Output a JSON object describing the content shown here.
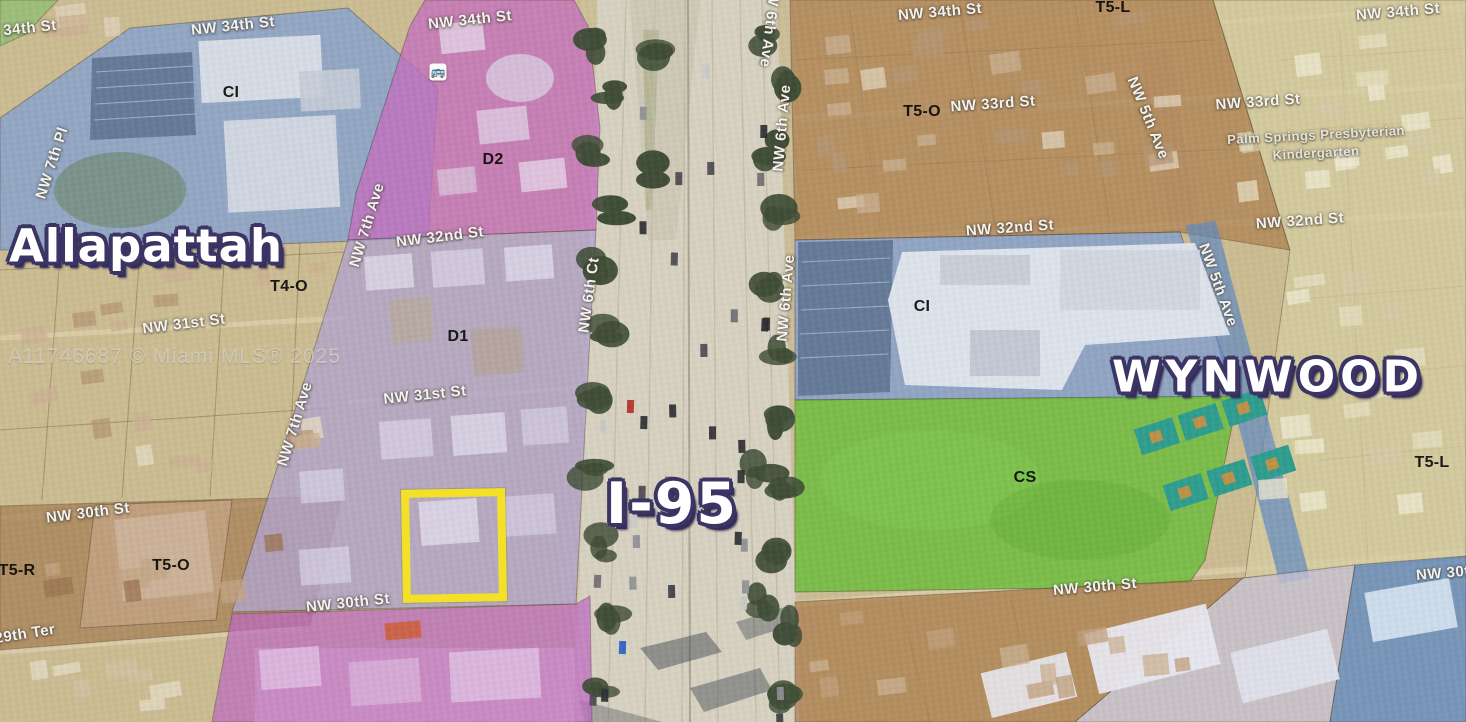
{
  "map": {
    "watermark": {
      "text": "A11746687 © Miami MLS® 2025"
    },
    "neighborhood_labels": [
      {
        "text": "Allapattah",
        "x": 146,
        "y": 246,
        "size": 45,
        "rot": 0,
        "spacing": 1
      },
      {
        "text": "WYNWOOD",
        "x": 1268,
        "y": 377,
        "size": 44,
        "rot": 0,
        "spacing": 5
      },
      {
        "text": "I-95",
        "x": 672,
        "y": 504,
        "size": 57,
        "rot": 0,
        "spacing": 2
      }
    ],
    "zone_labels": [
      {
        "text": "CI",
        "x": 231,
        "y": 93
      },
      {
        "text": "D2",
        "x": 493,
        "y": 160
      },
      {
        "text": "T4-O",
        "x": 289,
        "y": 287
      },
      {
        "text": "D1",
        "x": 458,
        "y": 337
      },
      {
        "text": "T5-O",
        "x": 171,
        "y": 566
      },
      {
        "text": "T5-R",
        "x": 17,
        "y": 571
      },
      {
        "text": "T5-L",
        "x": 1113,
        "y": 8
      },
      {
        "text": "T5-O",
        "x": 922,
        "y": 112
      },
      {
        "text": "CI",
        "x": 922,
        "y": 307
      },
      {
        "text": "CS",
        "x": 1025,
        "y": 478
      },
      {
        "text": "T5-L",
        "x": 1432,
        "y": 463
      }
    ],
    "street_labels": [
      {
        "text": "34th St",
        "x": 30,
        "y": 28,
        "rot": -6
      },
      {
        "text": "NW 34th St",
        "x": 233,
        "y": 26,
        "rot": -6
      },
      {
        "text": "NW 34th St",
        "x": 470,
        "y": 20,
        "rot": -6
      },
      {
        "text": "NW 34th St",
        "x": 940,
        "y": 12,
        "rot": -5
      },
      {
        "text": "NW 34th St",
        "x": 1398,
        "y": 12,
        "rot": -5
      },
      {
        "text": "NW 33rd St",
        "x": 993,
        "y": 104,
        "rot": -4
      },
      {
        "text": "NW 33rd St",
        "x": 1258,
        "y": 102,
        "rot": -4
      },
      {
        "text": "NW 32nd St",
        "x": 440,
        "y": 237,
        "rot": -7
      },
      {
        "text": "NW 32nd St",
        "x": 1010,
        "y": 228,
        "rot": -4
      },
      {
        "text": "NW 32nd St",
        "x": 1300,
        "y": 221,
        "rot": -4
      },
      {
        "text": "NW 31st St",
        "x": 184,
        "y": 324,
        "rot": -7
      },
      {
        "text": "NW 31st St",
        "x": 425,
        "y": 395,
        "rot": -6
      },
      {
        "text": "NW 30th St",
        "x": 88,
        "y": 513,
        "rot": -7
      },
      {
        "text": "NW 30th St",
        "x": 348,
        "y": 603,
        "rot": -6
      },
      {
        "text": "NW 30th St",
        "x": 1095,
        "y": 587,
        "rot": -5
      },
      {
        "text": "NW 30th St",
        "x": 1458,
        "y": 572,
        "rot": -5
      },
      {
        "text": "29th Ter",
        "x": 25,
        "y": 634,
        "rot": -9
      },
      {
        "text": "NW 7th Pl",
        "x": 52,
        "y": 163,
        "rot": -72
      },
      {
        "text": "NW 7th Ave",
        "x": 367,
        "y": 225,
        "rot": -73
      },
      {
        "text": "NW 7th Ave",
        "x": 295,
        "y": 424,
        "rot": -73
      },
      {
        "text": "NW 6th Ct",
        "x": 589,
        "y": 295,
        "rot": -82
      },
      {
        "text": "NW 6th Ave",
        "x": 770,
        "y": 24,
        "rot": 97
      },
      {
        "text": "NW 6th Ave",
        "x": 782,
        "y": 128,
        "rot": -85
      },
      {
        "text": "NW 6th Ave",
        "x": 786,
        "y": 298,
        "rot": -85
      },
      {
        "text": "NW 5th Ave",
        "x": 1148,
        "y": 118,
        "rot": 68
      },
      {
        "text": "NW 5th Ave",
        "x": 1218,
        "y": 285,
        "rot": 70
      },
      {
        "text": "Palm Springs Presbyterian",
        "x": 1316,
        "y": 135,
        "rot": -3,
        "size": 13,
        "cls": "poi"
      },
      {
        "text": "Kindergarten",
        "x": 1316,
        "y": 153,
        "rot": -3,
        "size": 13,
        "cls": "poi"
      }
    ],
    "highlight": {
      "x": 402,
      "y": 489,
      "width": 88,
      "height": 97,
      "border_color": "#f2e126",
      "border_width": 8
    },
    "icons": {
      "bus": "🚌"
    },
    "zone_colors": {
      "ci_blue": "#87a3cf",
      "d2_magenta": "#c66fc0",
      "d1_lavender": "#b2a5cf",
      "south_magenta": "#bf6ac2",
      "tan": "#d7c288",
      "brown_right": "#ad7f50",
      "brown_left": "#a57c52",
      "tan_light": "#d8cfa4",
      "green_cs": "#6fbe3e",
      "ave_blue": "#5d88c4",
      "lavender_south": "#c9c6da",
      "blue_corner": "#628dc6",
      "green_corner": "#8fbf72",
      "court_teal": "#2f9e8f",
      "label_outline": "#3b3464",
      "highway": "#d8d2c2",
      "tree": "#3f4d36"
    }
  }
}
